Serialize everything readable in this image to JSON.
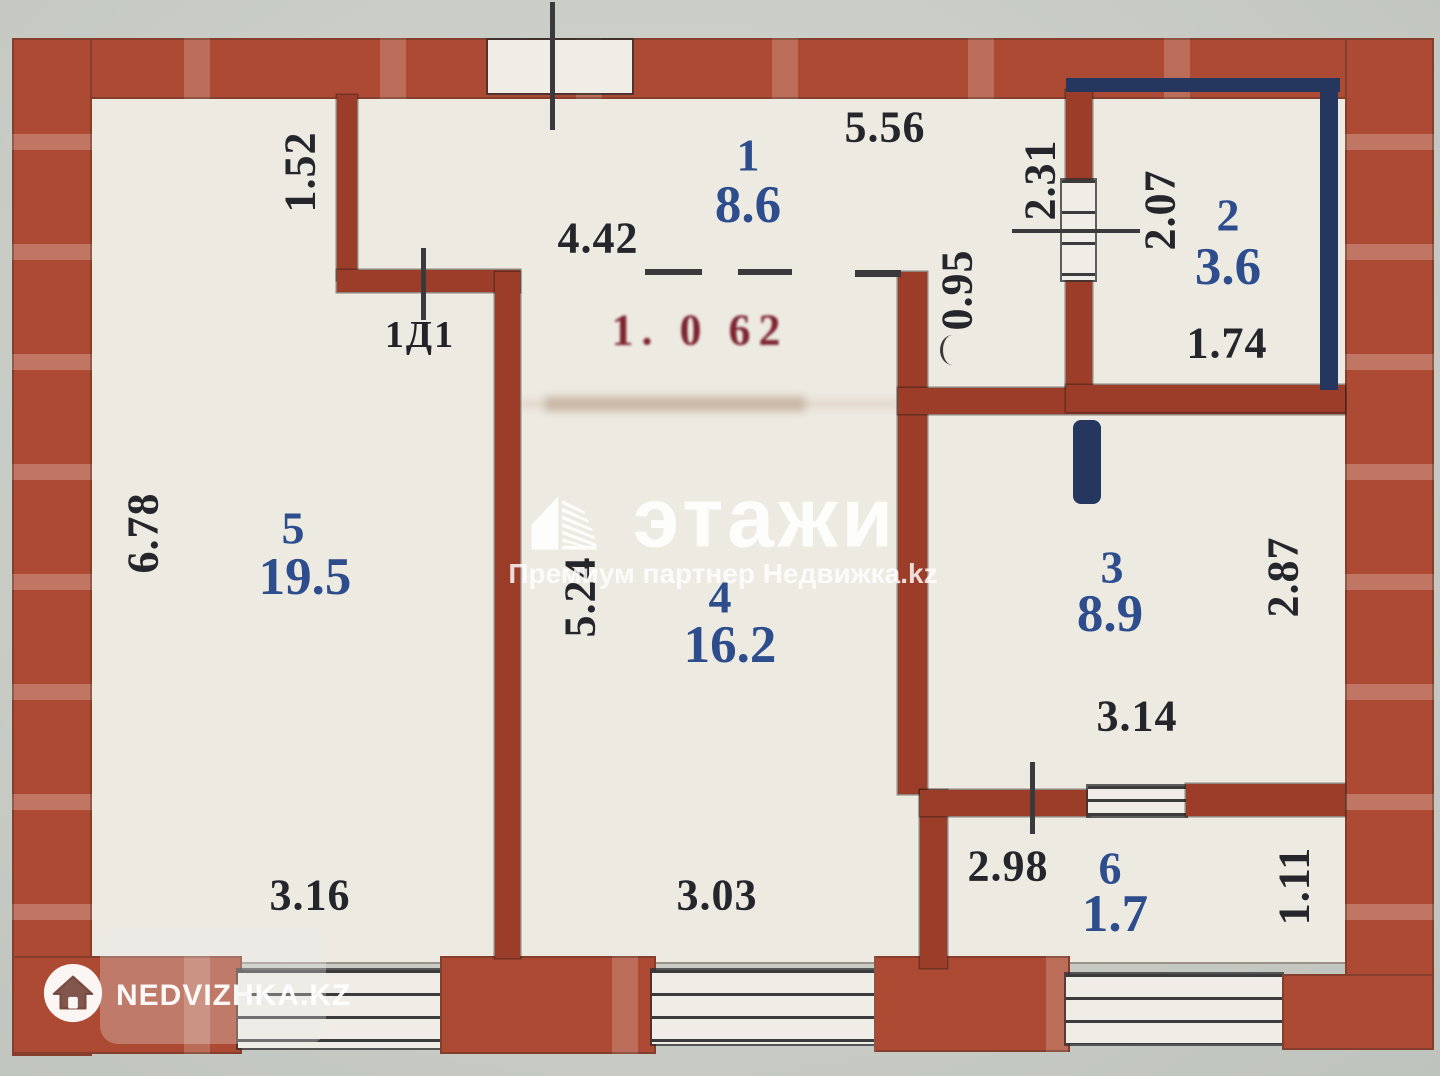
{
  "plan": {
    "rooms": {
      "r1": {
        "num": "1",
        "area": "8.6"
      },
      "r2": {
        "num": "2",
        "area": "3.6"
      },
      "r3": {
        "num": "3",
        "area": "8.9"
      },
      "r4": {
        "num": "4",
        "area": "16.2"
      },
      "r5": {
        "num": "5",
        "area": "19.5"
      },
      "r6": {
        "num": "6",
        "area": "1.7"
      }
    },
    "dims": {
      "v152": "1.52",
      "h442": "4.42",
      "h556": "5.56",
      "v231": "2.31",
      "v207": "2.07",
      "h174": "1.74",
      "v095": "0.95",
      "v678": "6.78",
      "v524": "5.24",
      "v287": "2.87",
      "h314": "3.14",
      "h316": "3.16",
      "h303": "3.03",
      "h298": "2.98",
      "v111": "1.11"
    },
    "door_label": "1Д1",
    "stamp": "1. 0 62"
  },
  "watermarks": {
    "center": {
      "brand": "этажи",
      "subtitle": "Премиум партнер Недвижка.kz"
    },
    "corner": {
      "brand": "NEDVIZHKA.KZ"
    }
  },
  "colors": {
    "wall": "#a8432f",
    "floor": "#edeae2",
    "background": "#c9cdc6",
    "navy": "#25365f",
    "room_label": "#2e4d8d",
    "dimension": "#25252c",
    "stamp": "#7c2330"
  }
}
